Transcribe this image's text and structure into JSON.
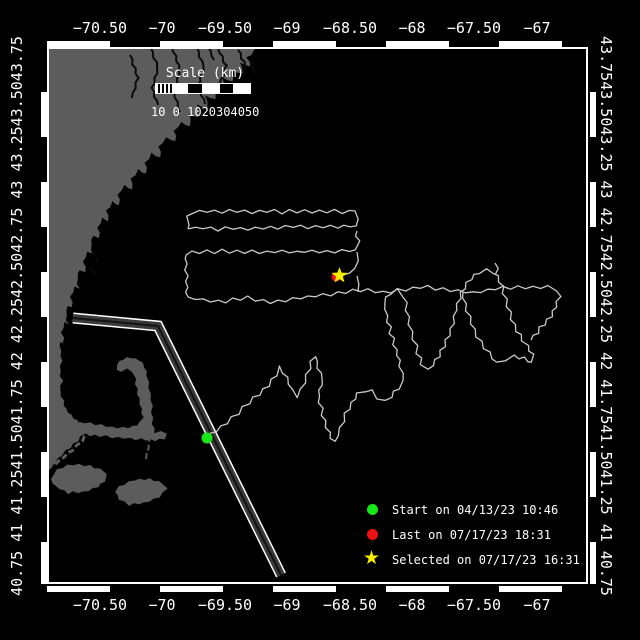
{
  "colors": {
    "background": "#000000",
    "land": "#5c5c5c",
    "track": "#c9c9c9",
    "frame": "#ffffff",
    "lane_fill": "#3a3a3a",
    "lane_center": "#151515",
    "start_green": "#16e716",
    "last_red": "#ee1111",
    "selected_yellow": "#f4ee00"
  },
  "axes": {
    "lon_labels": [
      {
        "text": "−70.50",
        "x": 100
      },
      {
        "text": "−70",
        "x": 162
      },
      {
        "text": "−69.50",
        "x": 225
      },
      {
        "text": "−69",
        "x": 287
      },
      {
        "text": "−68.50",
        "x": 350
      },
      {
        "text": "−68",
        "x": 412
      },
      {
        "text": "−67.50",
        "x": 474
      },
      {
        "text": "−67",
        "x": 537
      }
    ],
    "left_string": "40.75 41 41.2541.5041.75 42 42.2542.5042.75 43 43.2543.5043.75",
    "right_string": "43.7543.5043.25 43 42.7542.5042.25 42 41.7541.5041.25 41 40.75"
  },
  "scalebar": {
    "title": "Scale (km)",
    "numbers": "10 0 1020304050"
  },
  "legend": {
    "items": [
      {
        "marker": "circle",
        "color": "#16e716",
        "label": "Start on 04/13/23 10:46"
      },
      {
        "marker": "circle",
        "color": "#ee1111",
        "label": "Last on 07/17/23 18:31"
      },
      {
        "marker": "star",
        "color": "#f4ee00",
        "label": "Selected on 07/17/23 16:31"
      }
    ]
  },
  "map": {
    "plot": {
      "x": 47,
      "y": 47,
      "w": 543,
      "h": 543
    },
    "markers": {
      "start": {
        "x": 207,
        "y": 438,
        "r": 5.5
      },
      "last": {
        "x": 336,
        "y": 277,
        "r": 4.5
      },
      "selected": {
        "x": 339.5,
        "y": 275.5,
        "r": 8.5
      }
    },
    "lane": [
      [
        73,
        318
      ],
      [
        158,
        326
      ],
      [
        281,
        575
      ]
    ],
    "land": [
      [
        [
          47,
          47
        ],
        [
          258,
          47
        ],
        [
          247,
          58
        ],
        [
          251,
          66
        ],
        [
          240,
          63
        ],
        [
          243,
          73
        ],
        [
          231,
          70
        ],
        [
          234,
          81
        ],
        [
          222,
          78
        ],
        [
          225,
          90
        ],
        [
          213,
          87
        ],
        [
          216,
          99
        ],
        [
          205,
          96
        ],
        [
          208,
          108
        ],
        [
          197,
          105
        ],
        [
          199,
          117
        ],
        [
          189,
          114
        ],
        [
          191,
          126
        ],
        [
          181,
          123
        ],
        [
          174,
          131
        ],
        [
          176,
          141
        ],
        [
          166,
          138
        ],
        [
          159,
          147
        ],
        [
          161,
          157
        ],
        [
          151,
          154
        ],
        [
          145,
          163
        ],
        [
          147,
          173
        ],
        [
          138,
          170
        ],
        [
          131,
          179
        ],
        [
          133,
          189
        ],
        [
          124,
          186
        ],
        [
          118,
          195
        ],
        [
          120,
          205
        ],
        [
          112,
          202
        ],
        [
          107,
          211
        ],
        [
          109,
          221
        ],
        [
          102,
          218
        ],
        [
          98,
          228
        ],
        [
          100,
          238
        ],
        [
          94,
          235
        ],
        [
          91,
          245
        ],
        [
          93,
          255
        ],
        [
          87,
          252
        ],
        [
          84,
          262
        ],
        [
          86,
          272
        ],
        [
          80,
          269
        ],
        [
          77,
          279
        ],
        [
          79,
          289
        ],
        [
          74,
          287
        ],
        [
          71,
          297
        ],
        [
          73,
          307
        ],
        [
          68,
          305
        ],
        [
          66,
          315
        ],
        [
          68,
          325
        ],
        [
          64,
          323
        ],
        [
          62,
          333
        ],
        [
          64,
          343
        ],
        [
          61,
          341
        ],
        [
          60,
          351
        ],
        [
          62,
          361
        ],
        [
          60,
          371
        ],
        [
          62,
          381
        ],
        [
          60,
          391
        ],
        [
          63,
          401
        ],
        [
          66,
          409
        ],
        [
          71,
          415
        ],
        [
          77,
          421
        ],
        [
          83,
          427
        ],
        [
          87,
          431
        ],
        [
          81,
          437
        ],
        [
          74,
          444
        ],
        [
          66,
          451
        ],
        [
          58,
          459
        ],
        [
          50,
          467
        ],
        [
          47,
          470
        ]
      ],
      [
        [
          117,
          365
        ],
        [
          123,
          359
        ],
        [
          131,
          357
        ],
        [
          139,
          360
        ],
        [
          145,
          367
        ],
        [
          147,
          376
        ],
        [
          149,
          388
        ],
        [
          151,
          400
        ],
        [
          152,
          412
        ],
        [
          153,
          424
        ],
        [
          155,
          433
        ],
        [
          161,
          432
        ],
        [
          167,
          433
        ],
        [
          164,
          439
        ],
        [
          155,
          440
        ],
        [
          146,
          440
        ],
        [
          136,
          439
        ],
        [
          124,
          438
        ],
        [
          112,
          437
        ],
        [
          100,
          436
        ],
        [
          90,
          435
        ],
        [
          82,
          433
        ],
        [
          78,
          428
        ],
        [
          80,
          422
        ],
        [
          90,
          423
        ],
        [
          101,
          425
        ],
        [
          112,
          427
        ],
        [
          123,
          428
        ],
        [
          133,
          427
        ],
        [
          140,
          423
        ],
        [
          143,
          417
        ],
        [
          141,
          409
        ],
        [
          139,
          399
        ],
        [
          137,
          389
        ],
        [
          135,
          379
        ],
        [
          133,
          372
        ],
        [
          127,
          369
        ],
        [
          121,
          371
        ],
        [
          117,
          370
        ]
      ],
      [
        [
          57,
          469
        ],
        [
          73,
          464
        ],
        [
          90,
          466
        ],
        [
          104,
          471
        ],
        [
          107,
          478
        ],
        [
          98,
          487
        ],
        [
          83,
          492
        ],
        [
          68,
          493
        ],
        [
          56,
          487
        ],
        [
          51,
          479
        ]
      ],
      [
        [
          119,
          486
        ],
        [
          134,
          480
        ],
        [
          150,
          479
        ],
        [
          163,
          483
        ],
        [
          167,
          489
        ],
        [
          159,
          497
        ],
        [
          144,
          503
        ],
        [
          129,
          505
        ],
        [
          119,
          499
        ],
        [
          115,
          492
        ]
      ]
    ],
    "island_lines": [
      {
        "pts": [
          [
            48,
            469
          ],
          [
            60,
            460
          ],
          [
            72,
            450
          ],
          [
            82,
            441
          ],
          [
            87,
            433
          ]
        ],
        "w": 3
      },
      {
        "pts": [
          [
            151,
            436
          ],
          [
            148,
            448
          ],
          [
            146,
            460
          ]
        ],
        "w": 2
      }
    ],
    "rivers": [
      [
        [
          150,
          47
        ],
        [
          158,
          68
        ],
        [
          152,
          88
        ],
        [
          158,
          105
        ]
      ],
      [
        [
          172,
          47
        ],
        [
          180,
          70
        ],
        [
          174,
          92
        ],
        [
          180,
          112
        ]
      ],
      [
        [
          196,
          47
        ],
        [
          204,
          66
        ],
        [
          198,
          86
        ],
        [
          205,
          104
        ]
      ],
      [
        [
          218,
          48
        ],
        [
          226,
          66
        ],
        [
          220,
          84
        ]
      ],
      [
        [
          238,
          50
        ],
        [
          246,
          66
        ],
        [
          240,
          82
        ]
      ],
      [
        [
          130,
          55
        ],
        [
          138,
          78
        ],
        [
          132,
          98
        ]
      ],
      [
        [
          208,
          47
        ],
        [
          214,
          60
        ]
      ],
      [
        [
          250,
          60
        ],
        [
          256,
          74
        ]
      ],
      [
        [
          92,
          252
        ],
        [
          98,
          262
        ]
      ],
      [
        [
          90,
          266
        ],
        [
          96,
          274
        ]
      ]
    ],
    "tracks": [
      [
        [
          207,
          438
        ],
        [
          216,
          431
        ],
        [
          227,
          423
        ],
        [
          238,
          413
        ],
        [
          249,
          403
        ],
        [
          259,
          394
        ],
        [
          268,
          385
        ],
        [
          276,
          375
        ],
        [
          281,
          367
        ],
        [
          286,
          378
        ],
        [
          292,
          390
        ],
        [
          298,
          397
        ],
        [
          304,
          382
        ],
        [
          309,
          368
        ],
        [
          314,
          356
        ],
        [
          318,
          368
        ],
        [
          323,
          379
        ],
        [
          318,
          396
        ],
        [
          323,
          415
        ],
        [
          329,
          433
        ],
        [
          334,
          442
        ],
        [
          340,
          428
        ],
        [
          346,
          414
        ],
        [
          352,
          403
        ],
        [
          358,
          394
        ],
        [
          365,
          390
        ],
        [
          372,
          391
        ],
        [
          378,
          398
        ],
        [
          384,
          402
        ],
        [
          391,
          396
        ],
        [
          398,
          388
        ],
        [
          404,
          381
        ],
        [
          400,
          366
        ],
        [
          396,
          350
        ],
        [
          391,
          333
        ],
        [
          387,
          316
        ],
        [
          384,
          302
        ],
        [
          390,
          294
        ],
        [
          398,
          290
        ],
        [
          404,
          296
        ],
        [
          407,
          310
        ],
        [
          410,
          324
        ],
        [
          414,
          339
        ],
        [
          418,
          353
        ],
        [
          422,
          364
        ],
        [
          427,
          370
        ],
        [
          433,
          365
        ],
        [
          439,
          356
        ],
        [
          444,
          346
        ],
        [
          449,
          335
        ],
        [
          453,
          323
        ],
        [
          456,
          310
        ],
        [
          459,
          298
        ],
        [
          464,
          288
        ],
        [
          471,
          279
        ],
        [
          479,
          273
        ],
        [
          487,
          270
        ],
        [
          494,
          272
        ],
        [
          500,
          281
        ],
        [
          504,
          293
        ],
        [
          508,
          306
        ],
        [
          512,
          319
        ],
        [
          517,
          331
        ],
        [
          523,
          340
        ],
        [
          528,
          346
        ],
        [
          532,
          355
        ],
        [
          533,
          362
        ],
        [
          524,
          358
        ],
        [
          514,
          357
        ],
        [
          505,
          359
        ],
        [
          497,
          363
        ],
        [
          489,
          353
        ],
        [
          481,
          342
        ],
        [
          474,
          330
        ],
        [
          469,
          317
        ],
        [
          465,
          304
        ],
        [
          463,
          292
        ]
      ],
      [
        [
          188,
          297
        ],
        [
          203,
          300
        ],
        [
          218,
          302
        ],
        [
          233,
          300
        ],
        [
          248,
          298
        ],
        [
          263,
          301
        ],
        [
          278,
          302
        ],
        [
          293,
          299
        ],
        [
          308,
          297
        ],
        [
          323,
          295
        ],
        [
          338,
          293
        ],
        [
          353,
          291
        ],
        [
          368,
          290
        ],
        [
          383,
          292
        ],
        [
          398,
          290
        ],
        [
          413,
          288
        ],
        [
          428,
          287
        ],
        [
          443,
          289
        ],
        [
          458,
          291
        ],
        [
          473,
          293
        ],
        [
          488,
          290
        ],
        [
          503,
          288
        ],
        [
          518,
          287
        ],
        [
          533,
          288
        ],
        [
          548,
          287
        ],
        [
          557,
          289
        ],
        [
          559,
          297
        ],
        [
          556,
          307
        ],
        [
          551,
          316
        ],
        [
          544,
          324
        ],
        [
          537,
          332
        ],
        [
          531,
          340
        ]
      ],
      [
        [
          188,
          229
        ],
        [
          203,
          228
        ],
        [
          218,
          230
        ],
        [
          233,
          228
        ],
        [
          248,
          229
        ],
        [
          263,
          227
        ],
        [
          278,
          228
        ],
        [
          293,
          226
        ],
        [
          308,
          227
        ],
        [
          323,
          226
        ],
        [
          338,
          227
        ],
        [
          350,
          226
        ],
        [
          356,
          227
        ],
        [
          357,
          219
        ],
        [
          357,
          211
        ],
        [
          342,
          212
        ],
        [
          327,
          211
        ],
        [
          312,
          212
        ],
        [
          297,
          211
        ],
        [
          282,
          212
        ],
        [
          267,
          211
        ],
        [
          252,
          212
        ],
        [
          237,
          211
        ],
        [
          222,
          212
        ],
        [
          207,
          211
        ],
        [
          192,
          212
        ],
        [
          188,
          217
        ],
        [
          188,
          225
        ],
        [
          188,
          229
        ]
      ],
      [
        [
          357,
          231
        ],
        [
          358,
          241
        ],
        [
          357,
          250
        ],
        [
          342,
          251
        ],
        [
          327,
          252
        ],
        [
          312,
          251
        ],
        [
          297,
          252
        ],
        [
          282,
          251
        ],
        [
          267,
          252
        ],
        [
          252,
          251
        ],
        [
          237,
          252
        ],
        [
          222,
          251
        ],
        [
          207,
          252
        ],
        [
          192,
          252
        ],
        [
          186,
          253
        ],
        [
          186,
          264
        ],
        [
          187,
          276
        ],
        [
          186,
          287
        ],
        [
          188,
          297
        ]
      ],
      [
        [
          357,
          252
        ],
        [
          357,
          261
        ],
        [
          356,
          269
        ],
        [
          349,
          272
        ],
        [
          343,
          275
        ]
      ],
      [
        [
          358,
          292
        ],
        [
          357,
          284
        ],
        [
          357,
          276
        ]
      ],
      [
        [
          495,
          263
        ],
        [
          497,
          269
        ],
        [
          495,
          275
        ]
      ]
    ]
  },
  "layout_px": {
    "lon_label_top_y": 19,
    "lon_label_bottom_y": 596,
    "lat_left_cx": 17,
    "lat_right_cx": 606,
    "lat_cy": 316,
    "scale_title_x": 205,
    "scale_title_y": 66,
    "scalebar_x": 155,
    "scalebar_y": 83,
    "scalebar_w": 96,
    "scalebar_h": 11,
    "scale_nums_x": 151,
    "scale_nums_y": 105,
    "legend_marker_x": 367,
    "legend_text_x": 392,
    "legend_rows_y": [
      502,
      527,
      552
    ]
  }
}
